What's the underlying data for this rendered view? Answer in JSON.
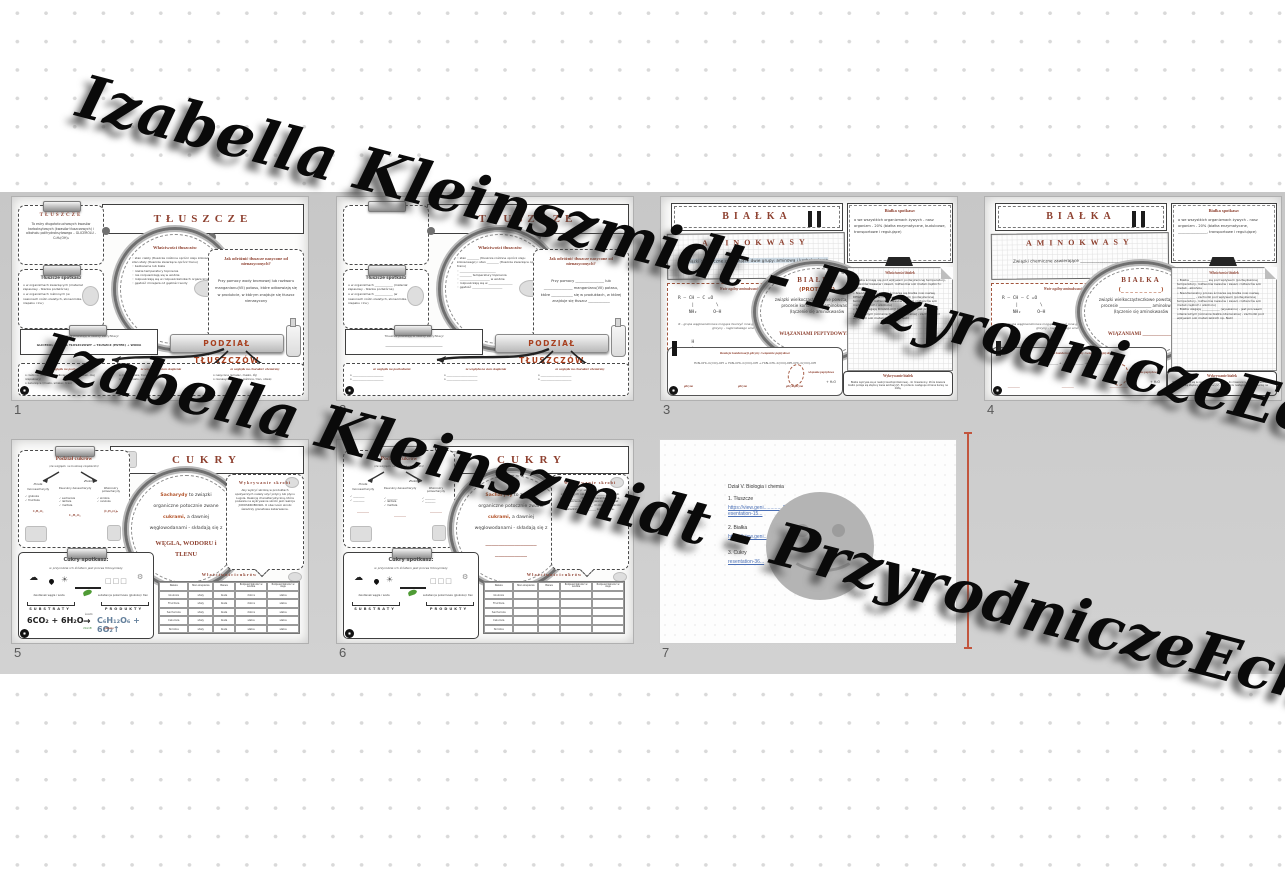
{
  "watermark": {
    "text": "Izabella Kleinszmidt - PrzyrodniczeEcho",
    "color": "#0a0a0a"
  },
  "colors": {
    "accent": "#8e4130",
    "band": "#c9c9c9",
    "insertion_line": "#c2553d",
    "link": "#4a6fb5"
  },
  "slides": [
    {
      "number": "1",
      "header": "TŁUSZCZE",
      "def_title": "TŁUSZCZE",
      "def_text": "To estry długołańcuchowych kwasów karboksylowych (kwasów tłuszczowych) i alkoholu polihydroksylowego – GLICEROLU - C₃H₅(OH)₃",
      "spot_title": "Tłuszcze spotkasz",
      "spot_items": [
        "w organizmach zwierzęcych (materiał zapasowy - tkanka podskórna)",
        "w organizmach roślinnych (w nasionach roślin oleistych, słonecznika, rzepaku i lnu)"
      ],
      "circle_title": "Właściwości tłuszczów",
      "circle_items": [
        "stan ciekły (tłuszcze roślinne oprócz oleju kokosowego) i stan stały (tłuszcze zwierzęce oprócz tranu)",
        "bezbarwne lub białe",
        "niskie temperatury topnienia",
        "nie rozpuszczają się w wodzie",
        "rozpuszczają się w rozpuszczalnikach organicznych",
        "gęstość mniejsza od gęstości wody"
      ],
      "right_title": "Jak odróżnić tłuszcze nasycone od nienasyconych?",
      "right_text": "Przy pomocy wody bromowej lub roztworu manganianu(VII) potasu, które odbarwiają się w produkcie, w którym znajduje się tłuszcz nienasycony",
      "ester_title": "Tłuszcze powstają w reakcji estryfikacji",
      "ester_formula": "GLICEROL + KWAS TŁUSZCZOWY → TŁUSZCZ (ESTER) + WODA",
      "button": "PODZIAŁ TŁUSZCZÓW",
      "col1_title": "ze względu na pochodzenie",
      "col1_text": "o roślinne (olej słonecznikowy, oliwa z oliwek, olej rzepakowy)\no zwierzęce (masło, smalec, tran)",
      "col2_title": "ze względu na stan skupienia",
      "col2_text": "o ciekłe (oliwa, tran, olej lniany)\no stałe (masło, smalec, łój)",
      "col3_title": "ze względu na charakter chemiczny",
      "col3_text": "o nasycone (smalec, masło, łój)\no nienasycone (oleje roślinne, tran, oliwa)"
    },
    {
      "number": "2",
      "header": "TŁUSZCZE",
      "def_title": "",
      "def_text": "",
      "spot_title": "Tłuszcze spotkasz",
      "spot_items": [
        "w organizmach ____________ (materiał zapasowy - tkanka podskórna)",
        "w organizmach ____________ (w nasionach roślin oleistych, słonecznika, rzepaku i lnu)"
      ],
      "circle_title": "Właściwości tłuszczów",
      "circle_items": [
        "stan ________ (tłuszcze roślinne oprócz oleju kokosowego) i stan ________ (tłuszcze zwierzęce oprócz tranu)",
        "________________________",
        "________ temperatury topnienia",
        "____________________ w wodzie",
        "rozpuszczają się w ________________",
        "gęstość ____________________"
      ],
      "right_title": "Jak odróżnić tłuszcze nasycone od nienasyconych?",
      "right_text": "Przy pomocy ________________ lub ________________ manganianu(VII) potasu, które ____________ się w produktach, w której znajduje się tłuszcz ____________",
      "ester_title": "Tłuszcze powstają w reakcji estryfikacji",
      "ester_formula": "______________________________________",
      "button": "PODZIAŁ TŁUSZCZÓW",
      "col1_title": "ze względu na pochodzenie",
      "col1_text": "o ______________________\no ______________________",
      "col2_title": "ze względu na stan skupienia",
      "col2_text": "o ______________________\no ______________________",
      "col3_title": "ze względu na charakter chemiczny",
      "col3_text": "o ______________________\no ______________________"
    },
    {
      "number": "3",
      "header": "BIAŁKA",
      "amino_title": "AMINOKWASY",
      "amino_text": "związki chemiczne zawierające dwie grupy: aminową i karboksylową",
      "general_title": "Wzór ogólny aminokwasów",
      "formula1": "R – CH – C =O\n     |        \\\n    NH₂      O–H",
      "note": "R - grupa węglowodorowa mogąca tworzyć inne grupy funkcyjne. Wzór cząsteczki glicyny - najprostszego aminokwasu:",
      "formula2": "     H\n     |\nH – C – C =O\n     |        \\\n    NH₂      O–H",
      "circle_title": "BIAŁKA",
      "circle_sub": "(PROTEINY)",
      "circle_text": "związki wielkocząsteczkowe powstające w procesie kondensacji aminokwasów (łączenie się aminokwasów",
      "circle_bold": "WIĄZANIAMI PEPTYDOWYMI)",
      "spot_title": "Białka spotkasz:",
      "spot_text": "o  we wszystkich organizmach żywych - nasz organizm - 20% (białka enzymatyczne, budulcowe, transportowe i regulujące)",
      "props_title": "Właściwości białek",
      "props_text": "• Białka ścinają się pod wpływem podwyższonej temperatury, roztworów kwasów i zasad, roztworów soli metali ciężkich i alkoholu\n• Nieodwracalny proces ścinania się białka nosi nazwę DENATURACJI - zachodzi pod wpływem (podwyższonej temperatury, roztworów kwasów i zasad, roztworów soli metali ciężkich i alkoholu)\n• Białka ulegają KOAGULACJI (wysalaniu) - jest procesem odwracalnym (ścinanie białka odwracalne) - zachodzi pod wpływem soli metali lekkich np. NaCl",
      "reaction_title": "Reakcja kondensacji glicyny i wiązanie peptydowe",
      "reaction_formula": "H₂N–CH₂–C(=O)–OH  +  H₂N–CH₂–C(=O)–OH   →   H₂N–CH₂–C(=O)–NH–CH₂–C(=O)–OH",
      "peptide_label": "wiązanie peptydowe",
      "label1": "glicyna",
      "label2": "glicyna",
      "label3": "glicyloglicyna",
      "water": "+ H₂O",
      "detect_title": "Wykrywanie białek",
      "detect_text": "Białka wykrywa się w reakcji ksantoproteinowej - do mieszaniny, która zawiera białko podaje się stężony kwas azotowy(V). Po podaniu następuje zmiana barwy na żółtą."
    },
    {
      "number": "4",
      "header": "BIAŁKA",
      "amino_title": "AMINOKWASY",
      "amino_text": "Związki chemiczne zawierające ________________________________",
      "general_title": "Wzór ogólny aminokwasów",
      "formula1": "R – CH – C =O\n     |        \\\n    NH₂      O–H",
      "note": "R - grupa węglowodorowa mogąca tworzyć inne grupy funkcyjne. Wzór cząsteczki glicyny - najprostszego aminokwasu:",
      "formula2": "     H\n     |\nH – C – C =O\n     |        \\\n    NH₂      O–H",
      "circle_title": "BIAŁKA",
      "circle_sub": "(_ _ _ _ _ _ _ _ _)",
      "circle_text": "związki wielkocząsteczkowe powstające w procesie ________________ aminokwasów (łączenie się aminokwasów",
      "circle_bold": "WIĄZANIAMI ____________)",
      "spot_title": "Białka spotkasz:",
      "spot_text": "o  we wszystkich organizmach żywych - nasz organizm - 20% (białka enzymatyczne, ________________, transportowe i regulujące)",
      "props_title": "Właściwości białek",
      "props_text": "• Białka ____________ się pod wpływem (podwyższonej temperatury, roztworów kwasów i zasad, roztworów soli metali - alkoholu\n• Nieodwracalny proces ścinania się białka nosi nazwę ____________ - zachodzi pod wpływem (podwyższonej temperatury, roztworów kwasów i zasad, roztworów soli metali ciężkich i alkoholu)\n• Białka ulegają ____________ (wysalaniu) - jest procesem odwracalnym (ścinanie białka odwracalne) - zachodzi pod wpływem soli metali lekkich np. NaCl",
      "reaction_title": "Reakcja kondensacji glicyny i wiązanie peptydowe",
      "reaction_formula": "______________  +  ______________   →   ______________________",
      "peptide_label": "wiązanie peptydowe",
      "label1": "________",
      "label2": "________",
      "label3": "____________",
      "water": "+ H₂O",
      "detect_title": "Wykrywanie białek",
      "detect_text": "Białka wykrywa się w reakcji ________________ - do mieszaniny, która zawiera białko podaje się stężony kwas azotowy(V). Po podaniu następuje zmiana barwy na ________."
    },
    {
      "number": "5",
      "header": "CUKRY",
      "podzial_title": "Podział cukrów",
      "podzial_sub": "(ze względu na budowę cząsteczki)",
      "b1_label": "Proste",
      "b1_name": "monosacharydy",
      "b1_items": [
        "✓ glukoza",
        "✓ fruktoza"
      ],
      "b1_formula": "C₆H₁₂O₆",
      "b2_label": "Złożone",
      "b2a_name": "Dwucukry dwusacharydy",
      "b2a_items": [
        "✓ sacharoza",
        "✓ laktoza",
        "✓ maltoza"
      ],
      "b2a_formula": "C₁₂H₂₂O₁₁",
      "b2b_name": "Wielocukry polisacharydy",
      "b2b_items": [
        "✓ skrobia",
        "✓ celuloza"
      ],
      "b2b_formula": "(C₆H₁₀O₅)ₙ",
      "c_w1": "Sacharydy",
      "c_l1": " to związki",
      "c_l2": "organiczne potocznie zwane",
      "c_w3": "cukrami,",
      "c_l3": " a dawniej",
      "c_l4": "węglowodanami - składają się z",
      "c_big": "WĘGLA, WODORU i\nTLENU",
      "detect_title": "Wykrywanie skrobi",
      "detect_text": "Aby wykryć skrobię w produktach spożywczych należy użyć jodyny lub płynu Lugola. Reakcją charakterystyczną, która pozwala na wykrywanie skrobi jest reakcja JODOSKROBIOWA. O obecności skrobi świadczy granatowe zabarwienie.",
      "spot_title": "Cukry spotkasz:",
      "spot_sub": "w przyrodzie ich źródłem jest proces fotosyntezy",
      "left_label": "dwutlenek węgla i woda",
      "right_label": "substancje pokarmowe (glukoza) i tlen",
      "substraty": "SUBSTRATY",
      "produkty": "PRODUKTY",
      "eq_left": "6CO₂ + 6H₂O",
      "eq_top": "światło",
      "eq_bottom": "chlorofil",
      "eq_right": "C₆H₁₂O₆ + 6O₂↑",
      "eq_sub": "glukoza",
      "table_title": "W ł a ś c i w o ś c i   c u k r ó w",
      "table": {
        "headers": [
          "Nazwa",
          "Stan skupienia",
          "Barwa",
          "Rozpuszczalność w wodzie",
          "Rozpuszczalność w oleju"
        ],
        "rows": [
          [
            "Glukoza",
            "stały",
            "biała",
            "dobra",
            "słaba"
          ],
          [
            "Fruktoza",
            "stały",
            "biała",
            "dobra",
            "słaba"
          ],
          [
            "Sacharoza",
            "stały",
            "biała",
            "dobra",
            "słaba"
          ],
          [
            "Celuloza",
            "stały",
            "biała",
            "słaba",
            "słaba"
          ],
          [
            "Skrobia",
            "stały",
            "biała",
            "słaba",
            "słaba"
          ]
        ]
      }
    },
    {
      "number": "6",
      "header": "CUKRY",
      "podzial_title": "Podział cukrów",
      "podzial_sub": "(ze względu na budowę cząsteczki)",
      "b1_label": "Proste",
      "b1_name": "monosacharydy",
      "b1_items": [
        "✓ ________",
        "✓ ________"
      ],
      "b1_formula": "________",
      "b2_label": "Złożone",
      "b2a_name": "Dwucukry dwusacharydy",
      "b2a_items": [
        "✓ ________",
        "✓ laktoza",
        "✓ maltoza"
      ],
      "b2a_formula": "________",
      "b2b_name": "Wielocukry polisacharydy",
      "b2b_items": [
        "✓ ________",
        "✓ ________"
      ],
      "b2b_formula": "________",
      "c_w1": "Sacharydy",
      "c_l1": " to związki",
      "c_l2": "organiczne potocznie zwane",
      "c_w3": "cukrami,",
      "c_l3": " a dawniej",
      "c_l4": "węglowodanami - składają się z",
      "c_big": "________________\n__________",
      "detect_title": "Wykrywanie skrobi",
      "detect_text": "Aby wykryć skrobię w produktach spożywczych należy użyć ____________ lub płynu ________. Reakcją charakterystyczną, która pozwala na wykrywanie skrobi jest reakcja ________________. O obecności skrobi świadczy ____________ zabarwienie.",
      "spot_title": "Cukry spotkasz:",
      "spot_sub": "w przyrodzie ich źródłem jest proces fotosyntezy",
      "left_label": "dwutlenek węgla i woda",
      "right_label": "substancje pokarmowe (glukoza) i tlen",
      "substraty": "SUBSTRATY",
      "produkty": "PRODUKTY",
      "eq_left": "",
      "eq_top": "",
      "eq_bottom": "",
      "eq_right": "",
      "eq_sub": "",
      "table_title": "W ł a ś c i w o ś c i   c u k r ó w",
      "table": {
        "headers": [
          "Nazwa",
          "Stan skupienia",
          "Barwa",
          "Rozpuszczalność w wodzie",
          "Rozpuszczalność w oleju"
        ],
        "rows": [
          [
            "Glukoza",
            "",
            "",
            "",
            ""
          ],
          [
            "Fruktoza",
            "",
            "",
            "",
            ""
          ],
          [
            "Sacharoza",
            "",
            "",
            "",
            ""
          ],
          [
            "Celuloza",
            "",
            "",
            "",
            ""
          ],
          [
            "Skrobia",
            "",
            "",
            "",
            ""
          ]
        ]
      }
    },
    {
      "number": "7",
      "l1": "Dział V. Biologia i chemia",
      "l2": "1. Tłuszcze",
      "link1": "https://view.geni..............5b5d/pr",
      "link2": "esentation-15...",
      "l3": "2. Białka",
      "link3": "https://view.geni.....................",
      "l4": "3. Cukry",
      "link4": "resentation-36..."
    }
  ]
}
